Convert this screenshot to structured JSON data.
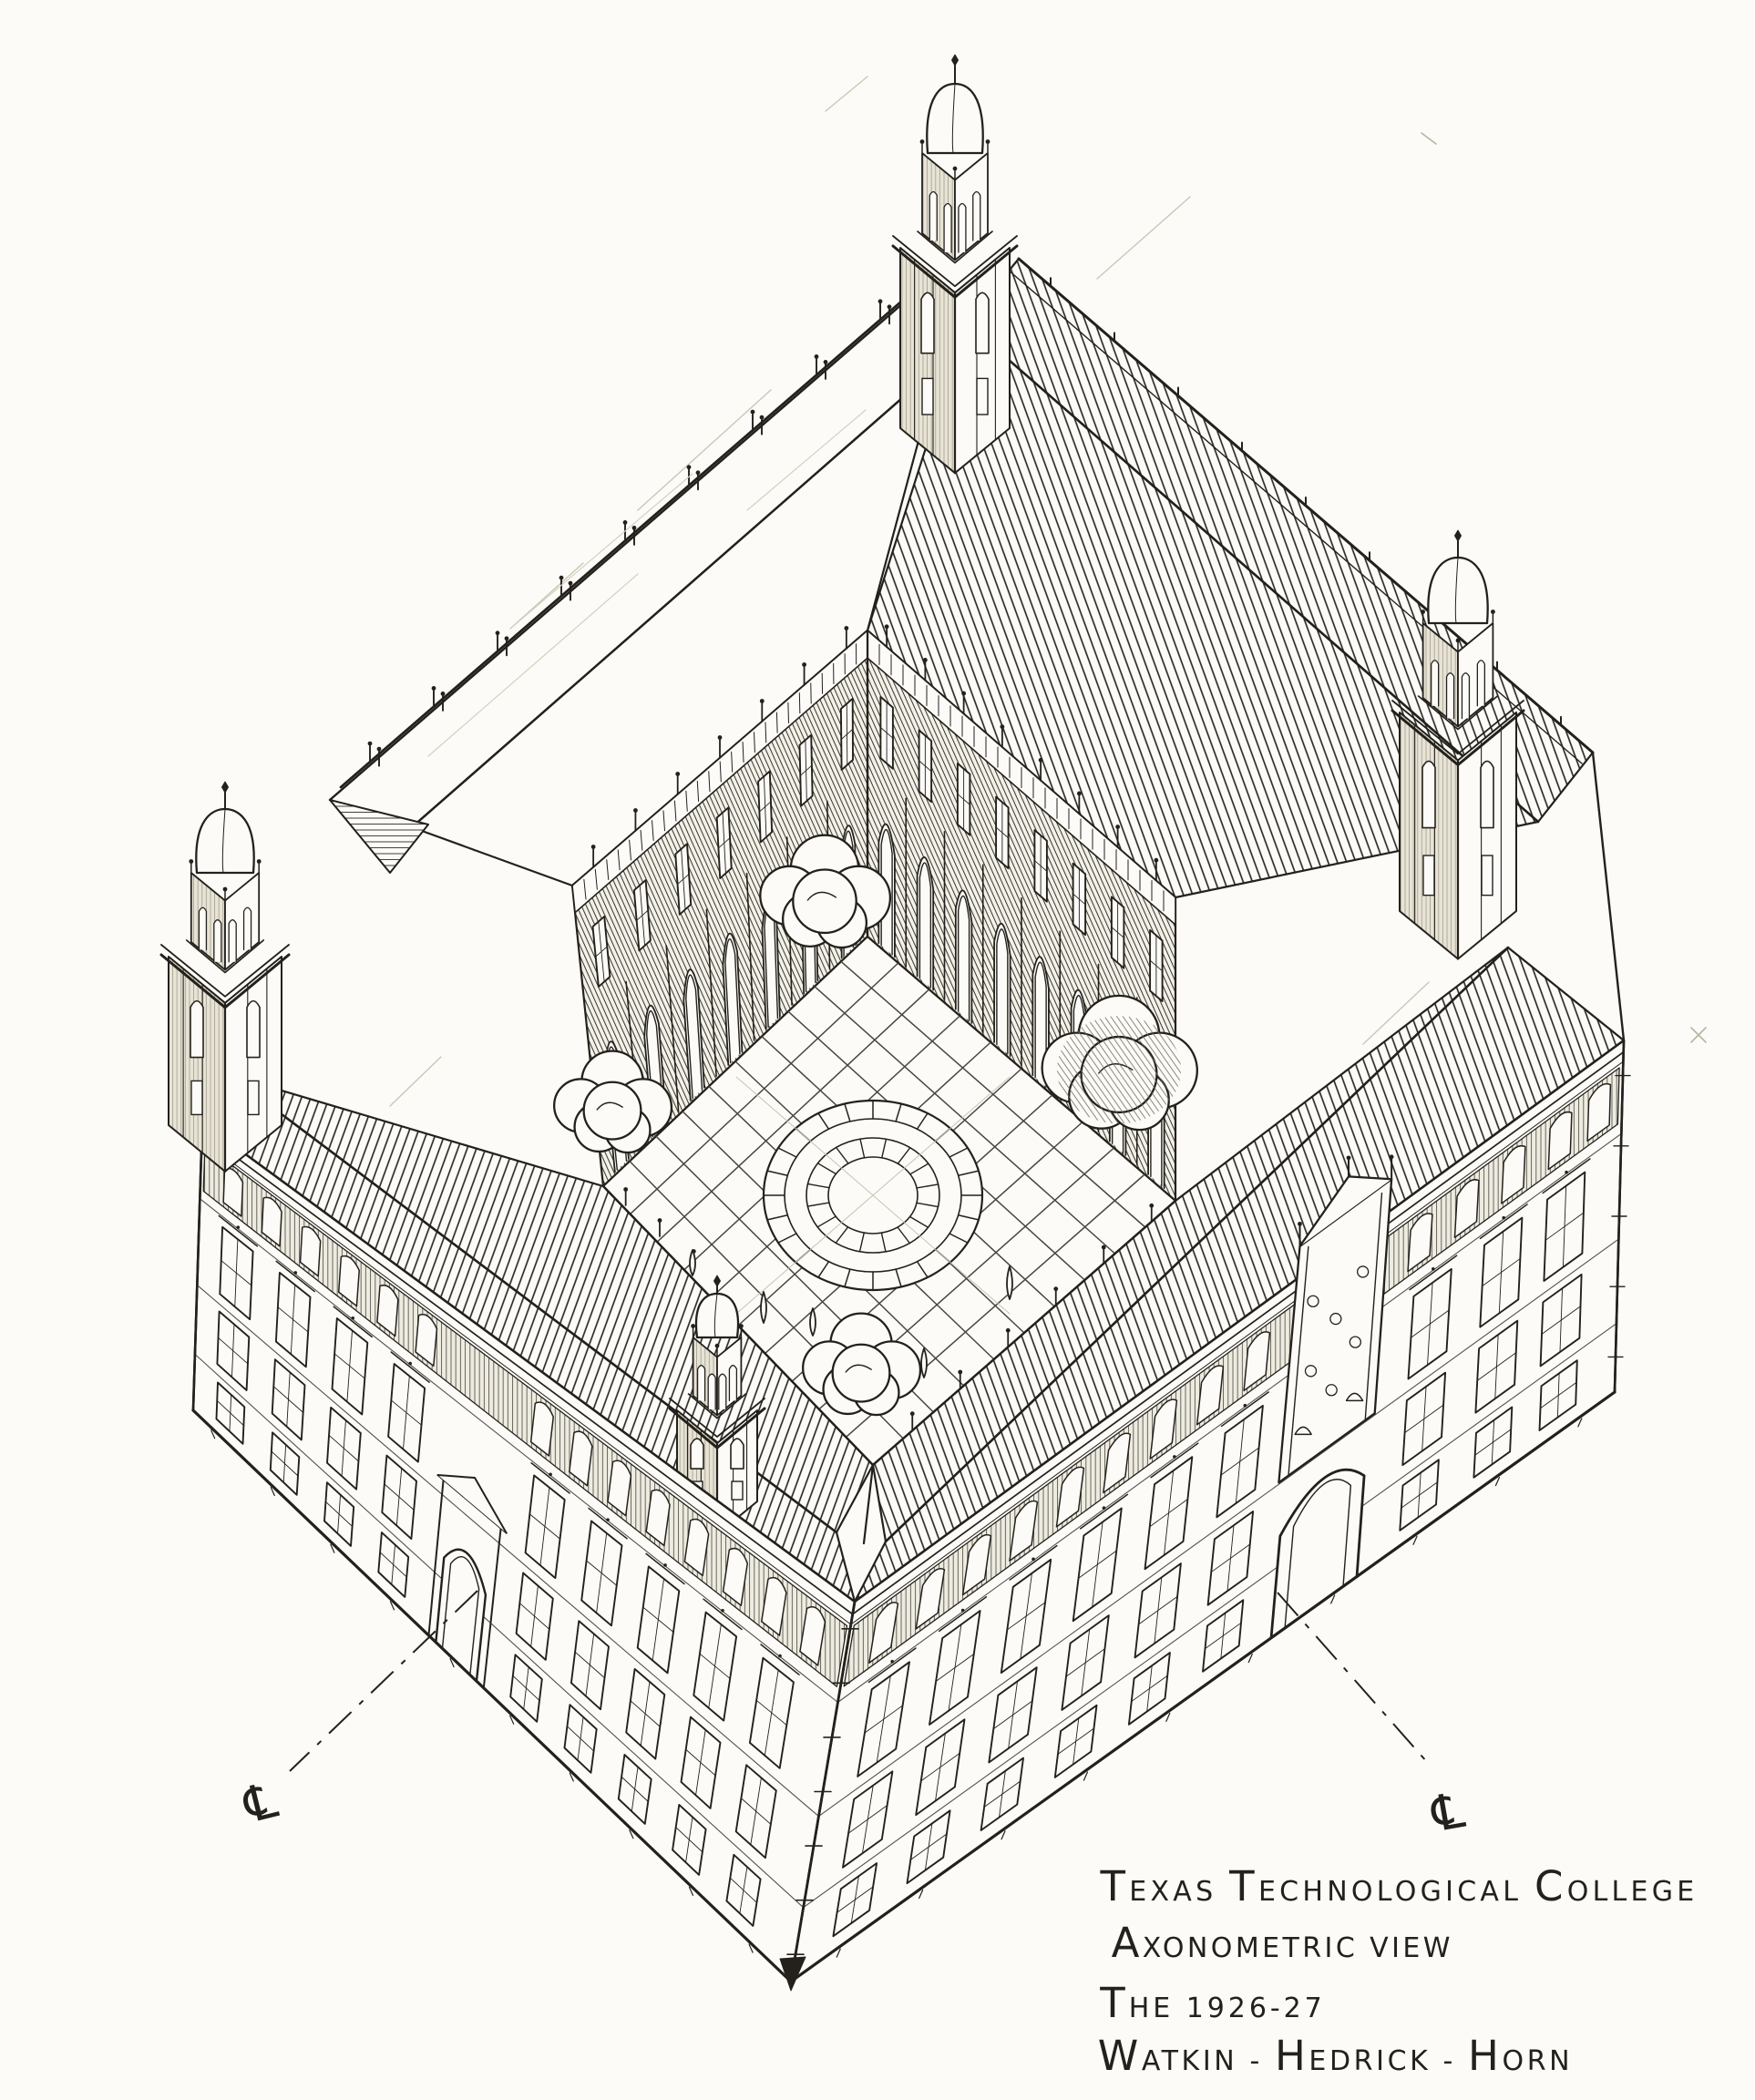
{
  "caption": {
    "l1a": "T",
    "l1b": "EXAS ",
    "l1c": "T",
    "l1d": "ECHNOLOGICAL ",
    "l1e": "C",
    "l1f": "OLLEGE",
    "l2a": "A",
    "l2b": "XONOMETRIC VIEW",
    "l3a": "T",
    "l3b": "HE 1926-27",
    "l4a": "W",
    "l4b": "ATKIN - ",
    "l4c": "H",
    "l4d": "EDRICK - ",
    "l4e": "H",
    "l4f": "ORN"
  },
  "annotations": {
    "centerline_left": "℄",
    "centerline_right": "℄"
  },
  "colors": {
    "ink": "#24211c",
    "paper": "#fcfbf7",
    "pencil": "#c9c3b1"
  }
}
